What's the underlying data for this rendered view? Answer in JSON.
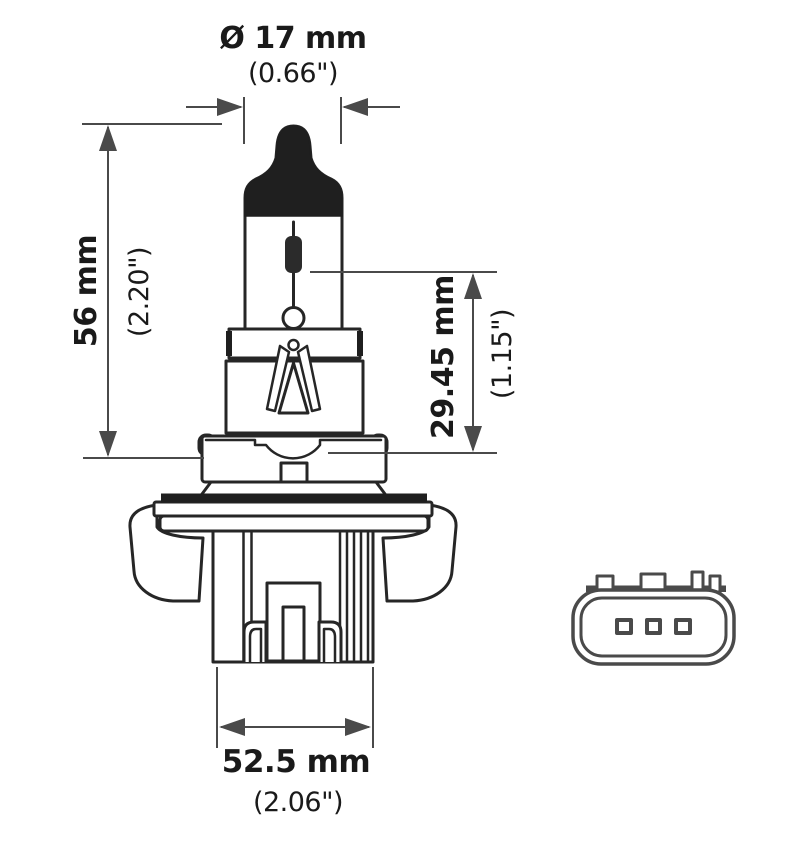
{
  "diagram": {
    "type": "technical-dimension-drawing",
    "dimensions": {
      "diameter": {
        "metric": "Ø 17 mm",
        "imperial": "(0.66\")"
      },
      "overall_length": {
        "metric": "56 mm",
        "imperial": "(2.20\")"
      },
      "light_center_length": {
        "metric": "29.45 mm",
        "imperial": "(1.15\")"
      },
      "base_width": {
        "metric": "52.5 mm",
        "imperial": "(2.06\")"
      }
    },
    "colors": {
      "drawing_line": "#262626",
      "dimension_line": "#4a4a4a",
      "connector_line": "#4a4a4a",
      "background": "#ffffff"
    }
  }
}
